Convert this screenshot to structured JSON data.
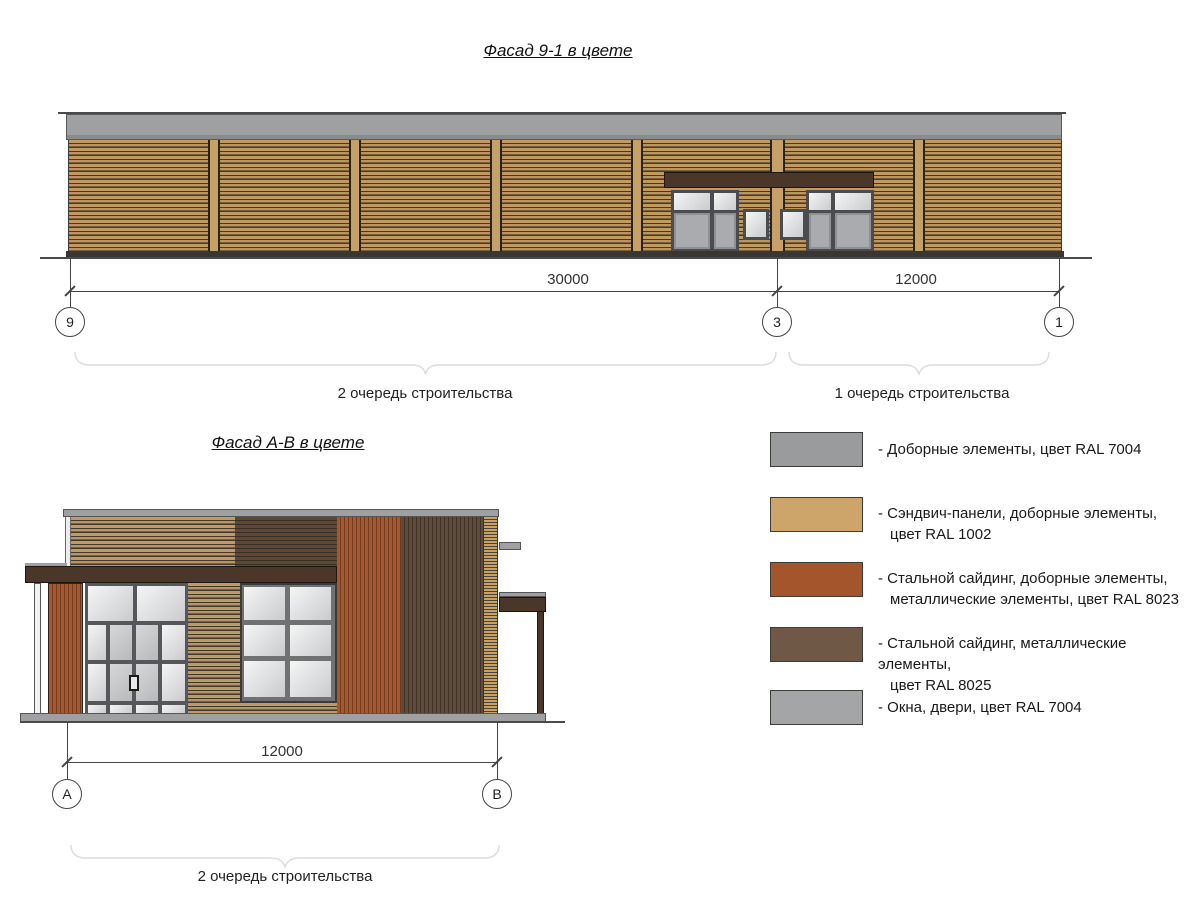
{
  "facade_top": {
    "title": "Фасад 9-1 в цвете",
    "dim_main": "30000",
    "dim_right": "12000",
    "axis_left": "9",
    "axis_mid": "3",
    "axis_right": "1",
    "phase_left": "2 очередь строительства",
    "phase_right": "1 очередь строительства"
  },
  "facade_ab": {
    "title": "Фасад А-В в цвете",
    "dim": "12000",
    "axis_left": "А",
    "axis_right": "В",
    "phase": "2 очередь строительства"
  },
  "legend": {
    "items": [
      {
        "color": "#999B9D",
        "lines": [
          "- Доборные элементы, цвет RAL 7004",
          ""
        ]
      },
      {
        "color": "#CDA56B",
        "lines": [
          "- Сэндвич-панели, доборные элементы,",
          "цвет RAL 1002"
        ]
      },
      {
        "color": "#A4552B",
        "lines": [
          "- Стальной сайдинг, доборные элементы,",
          "металлические элементы, цвет RAL 8023"
        ]
      },
      {
        "color": "#6F5846",
        "lines": [
          "- Стальной сайдинг, металлические элементы,",
          "цвет RAL 8025"
        ]
      },
      {
        "color": "#A3A5A7",
        "lines": [
          "- Окна, двери, цвет RAL 7004",
          ""
        ]
      }
    ]
  },
  "materials": {
    "ral7004_gray": "#9EA0A2",
    "ral1002_sand": "#C7A167",
    "ral8023_orange": "#A8582E",
    "ral8025_brown": "#5E4C3B",
    "canopy_dark_brown": "#4A3729",
    "glass_light": "#F4F5F5",
    "glass_shade": "#C9CBCD",
    "frame_gray": "#55575A"
  }
}
